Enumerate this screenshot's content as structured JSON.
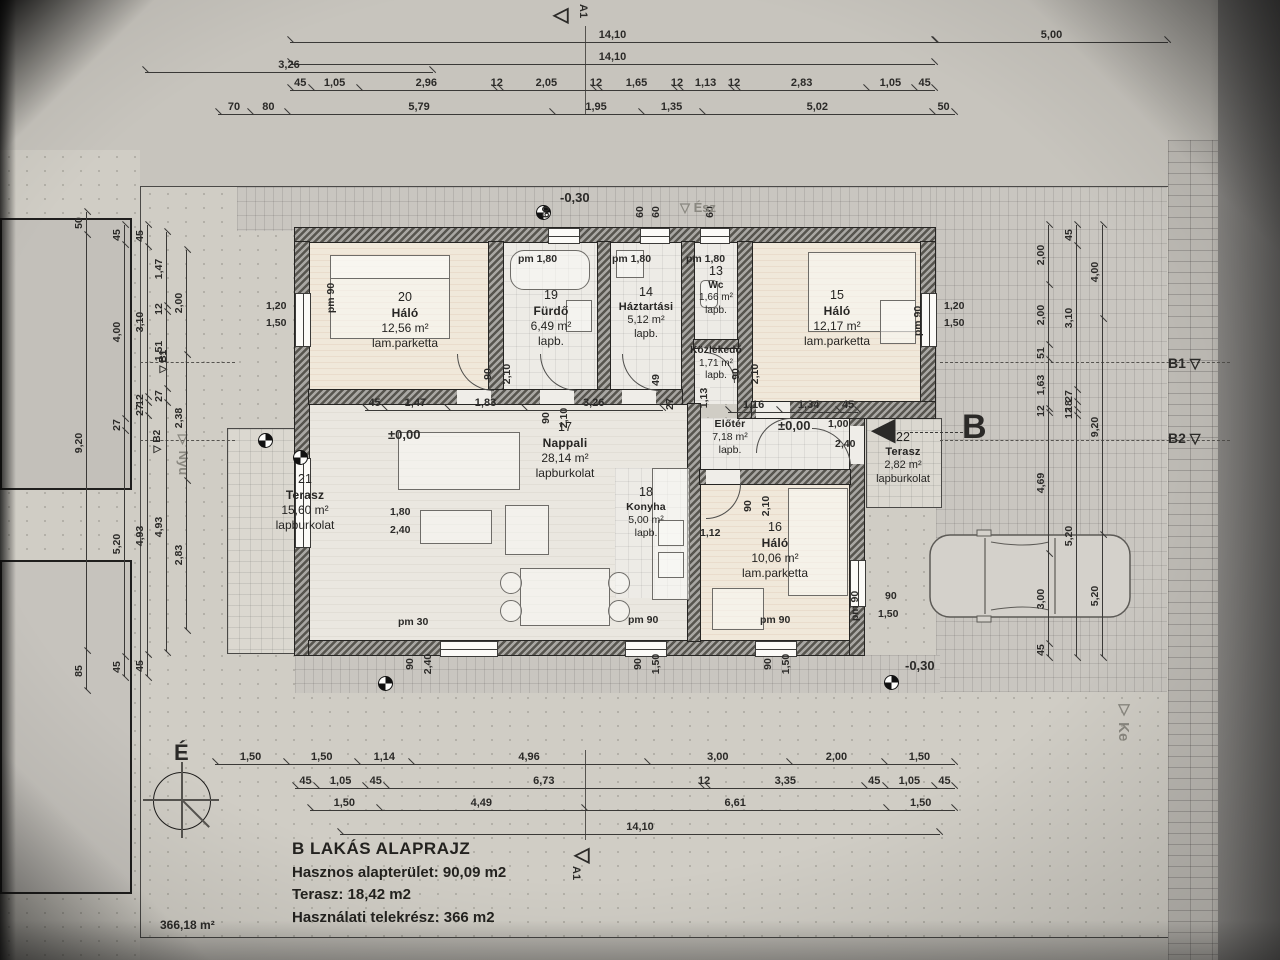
{
  "title_block": {
    "line1": "B LAKÁS ALAPRAJZ",
    "line2": "Hasznos alapterület: 90,09 m2",
    "line3": "Terasz:  18,42 m2",
    "line4": "Használati telekrész: 366 m2"
  },
  "markers": {
    "north": "É",
    "site_area": "366,18 m²",
    "a_top": "A1",
    "a_bottom": "A1",
    "b_entry": "B",
    "b1": "B1",
    "b2": "B2",
    "nyu": "▽ Nyu",
    "ke": "▽ Ke",
    "esz": "▽ Ész",
    "tri_open": "▽",
    "tri_left_open": "◁",
    "tri_solid_left": "◀"
  },
  "levels": {
    "zero": "±0,00",
    "minus30": "-0,30"
  },
  "rooms": [
    {
      "num": "20",
      "name": "Háló",
      "area": "12,56 m²",
      "floor": "lam.parketta"
    },
    {
      "num": "19",
      "name": "Fürdő",
      "area": "6,49 m²",
      "floor": "lapb."
    },
    {
      "num": "14",
      "name": "Háztartási",
      "area": "5,12 m²",
      "floor": "lapb."
    },
    {
      "num": "13",
      "name": "Wc",
      "area": "1,66 m²",
      "floor": "lapb."
    },
    {
      "num": "",
      "name": "Közlekedő",
      "area": "1,71 m²",
      "floor": "lapb."
    },
    {
      "num": "15",
      "name": "Háló",
      "area": "12,17 m²",
      "floor": "lam.parketta"
    },
    {
      "num": "17",
      "name": "Nappali",
      "area": "28,14 m²",
      "floor": "lapburkolat"
    },
    {
      "num": "18",
      "name": "Konyha",
      "area": "5,00 m²",
      "floor": "lapb."
    },
    {
      "num": "",
      "name": "Előtér",
      "area": "7,18 m²",
      "floor": "lapb."
    },
    {
      "num": "16",
      "name": "Háló",
      "area": "10,06 m²",
      "floor": "lam.parketta"
    },
    {
      "num": "21",
      "name": "Terasz",
      "area": "15,60 m²",
      "floor": "lapburkolat"
    },
    {
      "num": "22",
      "name": "Terasz",
      "area": "2,82 m²",
      "floor": "lapburkolat"
    }
  ],
  "dims": {
    "top": {
      "total1": [
        "14,10"
      ],
      "right": [
        "5,00"
      ],
      "total2": [
        "14,10"
      ],
      "left": [
        "3,26"
      ],
      "chain3": [
        "45",
        "1,05",
        "2,96",
        "12",
        "2,05",
        "12",
        "1,65",
        "12",
        "1,13",
        "12",
        "2,83",
        "1,05",
        "45"
      ],
      "chain4": [
        "70",
        "80",
        "5,79",
        "1,95",
        "1,35",
        "5,02",
        "50"
      ]
    },
    "bottom": {
      "chain1": [
        "1,50",
        "1,50",
        "1,14",
        "4,96",
        "3,00",
        "2,00",
        "1,50"
      ],
      "chain2": [
        "45",
        "1,05",
        "45",
        "6,73",
        "12",
        "3,35",
        "45",
        "1,05",
        "45"
      ],
      "chain3": [
        "1,50",
        "4,49",
        "6,61",
        "1,50"
      ],
      "total": [
        "14,10"
      ]
    },
    "left": {
      "c1": [
        "50",
        "9,20",
        "85"
      ],
      "c2": [
        "45",
        "4,00",
        "27",
        "5,20",
        "45"
      ],
      "c3": [
        "45",
        "3,10",
        "12",
        "27",
        "4,93",
        "45"
      ],
      "c4": [
        "1,47",
        "12",
        "1,51",
        "27",
        "4,93"
      ],
      "c5": [
        "2,00",
        "2,38",
        "2,83"
      ]
    },
    "right": {
      "c1": [
        "2,00",
        "2,00",
        "51",
        "1,63",
        "12",
        "4,69",
        "3,00",
        "45"
      ],
      "c2": [
        "45",
        "3,10",
        "27",
        "18",
        "12",
        "5,20"
      ],
      "c3": [
        "4,00",
        "9,20",
        "5,20"
      ]
    },
    "interior": {
      "hall": [
        "45",
        "1,47",
        "1,83",
        "3,26"
      ],
      "entry": [
        "1,16",
        "1,34",
        "45"
      ]
    }
  },
  "ann": {
    "pm180": "pm 1,80",
    "pm90": "pm 90",
    "pm30": "pm 30",
    "w60": "60",
    "w120": "1,20",
    "w150": "1,50",
    "d90": "90",
    "d210": "2,10",
    "d240": "2,40",
    "d180": "1,80",
    "d100": "1,00",
    "d113": "1,13",
    "d112": "1,12",
    "d27": "27",
    "d49": "49",
    "d150": "1,50"
  }
}
